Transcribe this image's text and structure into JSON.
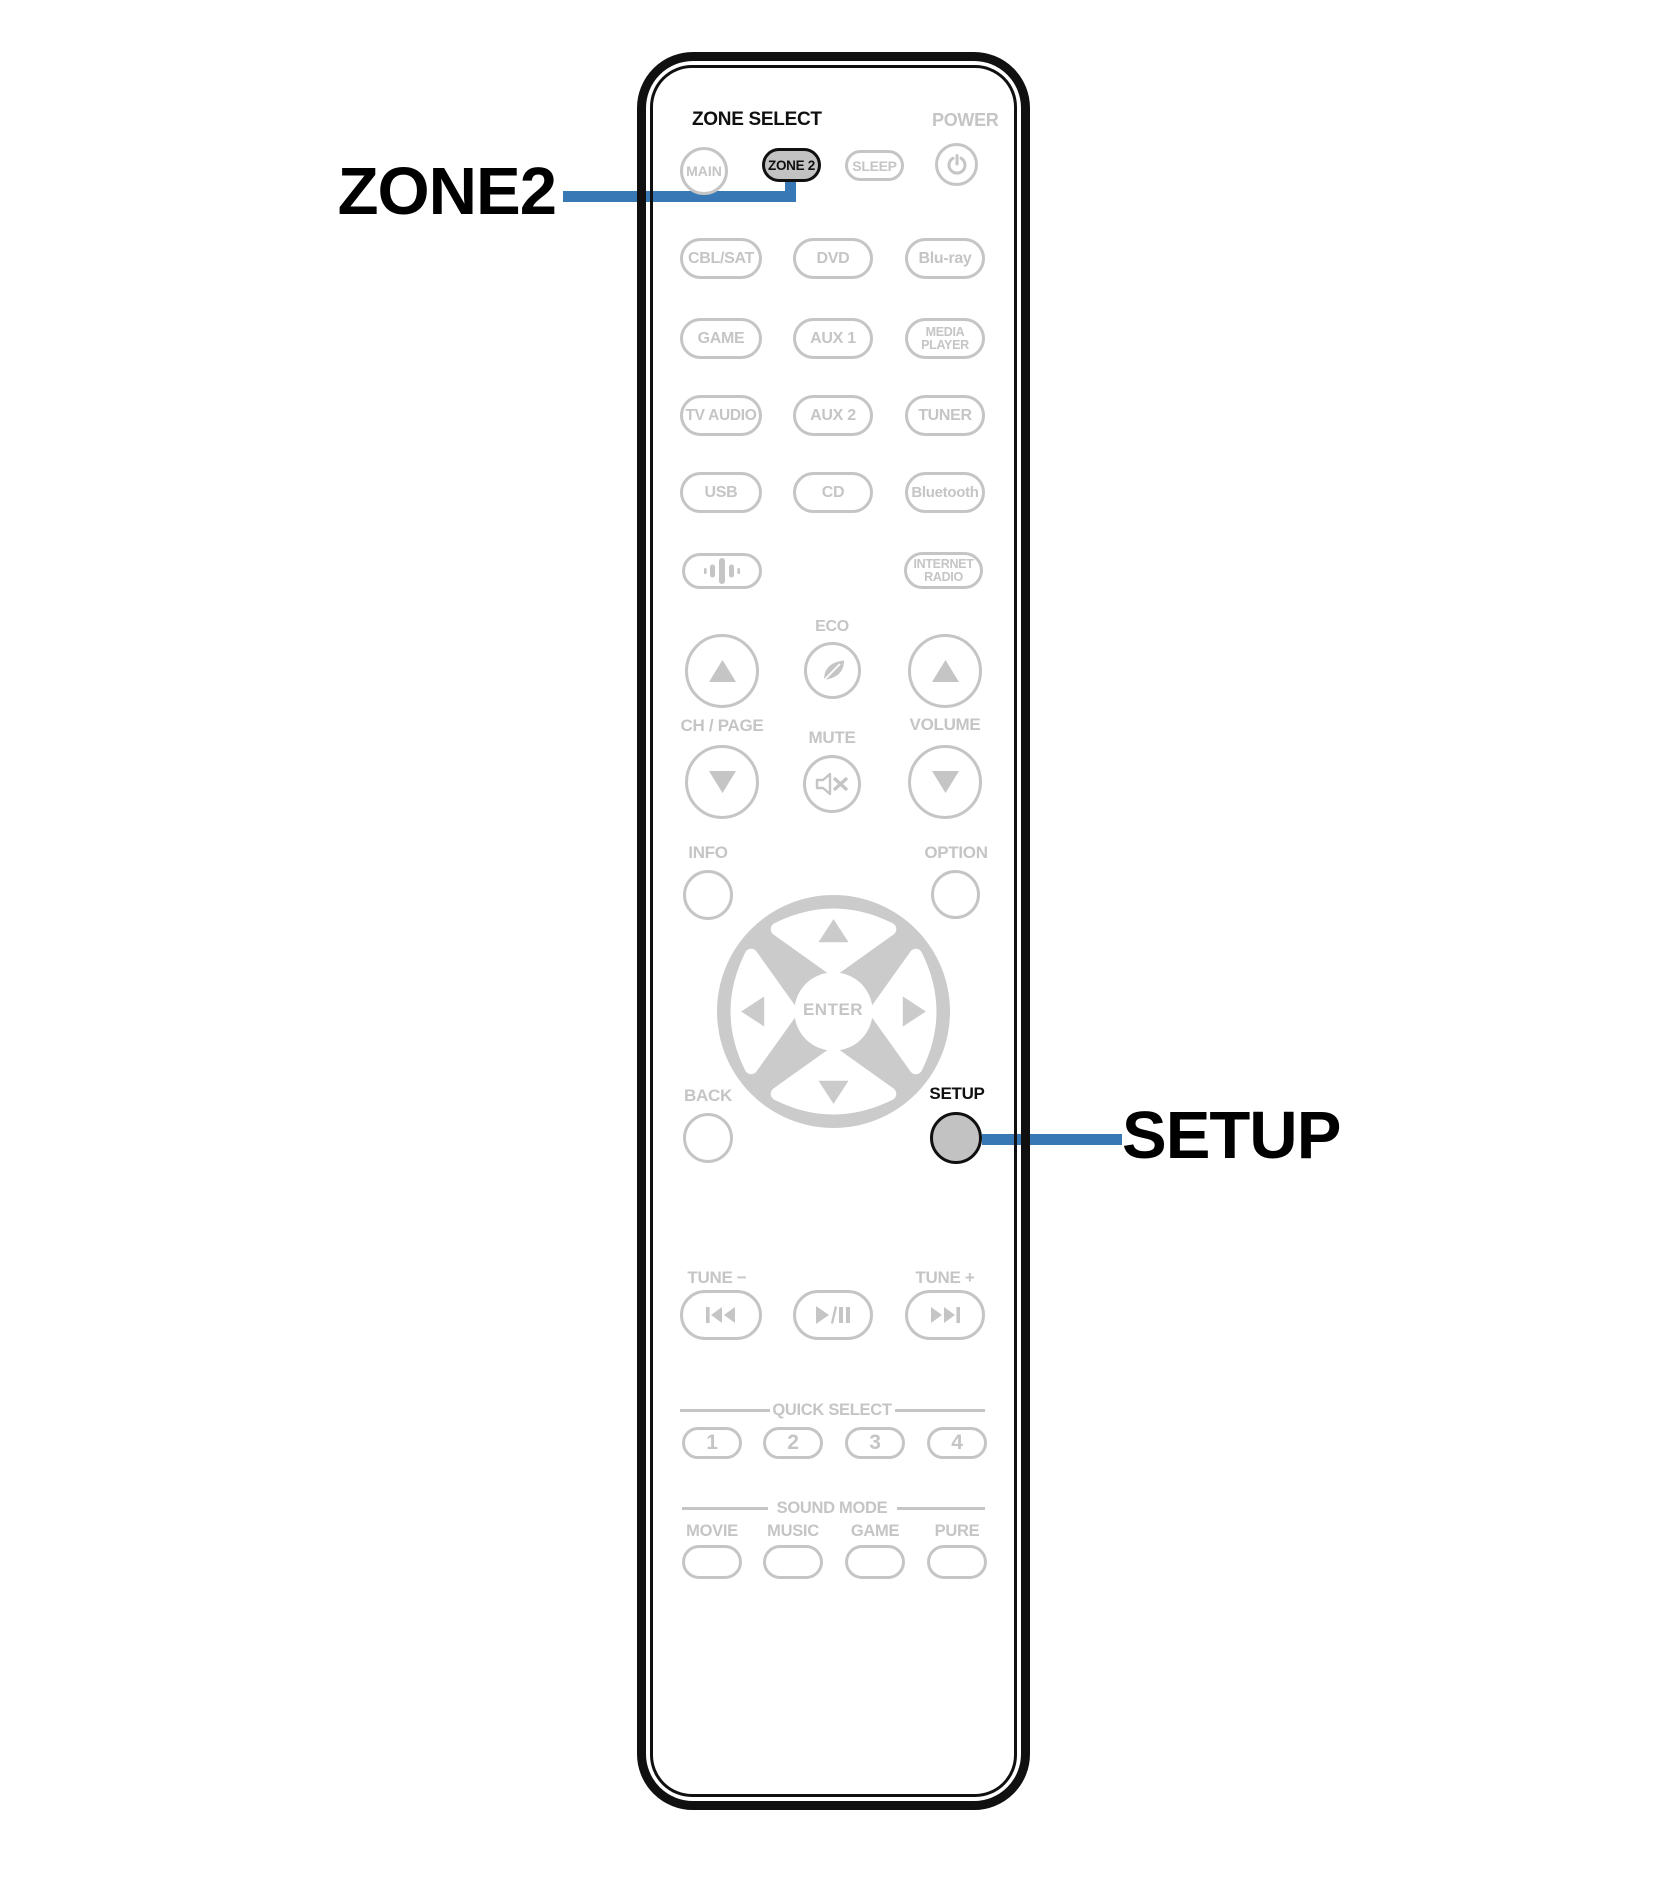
{
  "colors": {
    "accent_blue": "#3878b4",
    "button_gray": "#c5c5c5",
    "highlight_fill": "#c2c2c2",
    "outline_black": "#101010"
  },
  "callouts": {
    "zone2_label": "ZONE2",
    "setup_label": "SETUP"
  },
  "remote": {
    "zone_select_label": "ZONE SELECT",
    "power_label": "POWER",
    "main_button": "MAIN",
    "zone2_button": "ZONE 2",
    "sleep_button": "SLEEP",
    "sources": {
      "row1": [
        "CBL/SAT",
        "DVD",
        "Blu-ray"
      ],
      "row2": [
        "GAME",
        "AUX 1"
      ],
      "media_player_line1": "MEDIA",
      "media_player_line2": "PLAYER",
      "row3": [
        "TV AUDIO",
        "AUX 2",
        "TUNER"
      ],
      "row4": [
        "USB",
        "CD",
        "Bluetooth"
      ],
      "internet_radio_line1": "INTERNET",
      "internet_radio_line2": "RADIO"
    },
    "eco_label": "ECO",
    "ch_page_label": "CH / PAGE",
    "mute_label": "MUTE",
    "volume_label": "VOLUME",
    "info_label": "INFO",
    "option_label": "OPTION",
    "enter_label": "ENTER",
    "back_label": "BACK",
    "setup_label": "SETUP",
    "tune_minus_label": "TUNE −",
    "tune_plus_label": "TUNE +",
    "quick_select_label": "QUICK SELECT",
    "quick_select_buttons": [
      "1",
      "2",
      "3",
      "4"
    ],
    "sound_mode_label": "SOUND MODE",
    "sound_mode_buttons": [
      "MOVIE",
      "MUSIC",
      "GAME",
      "PURE"
    ]
  }
}
